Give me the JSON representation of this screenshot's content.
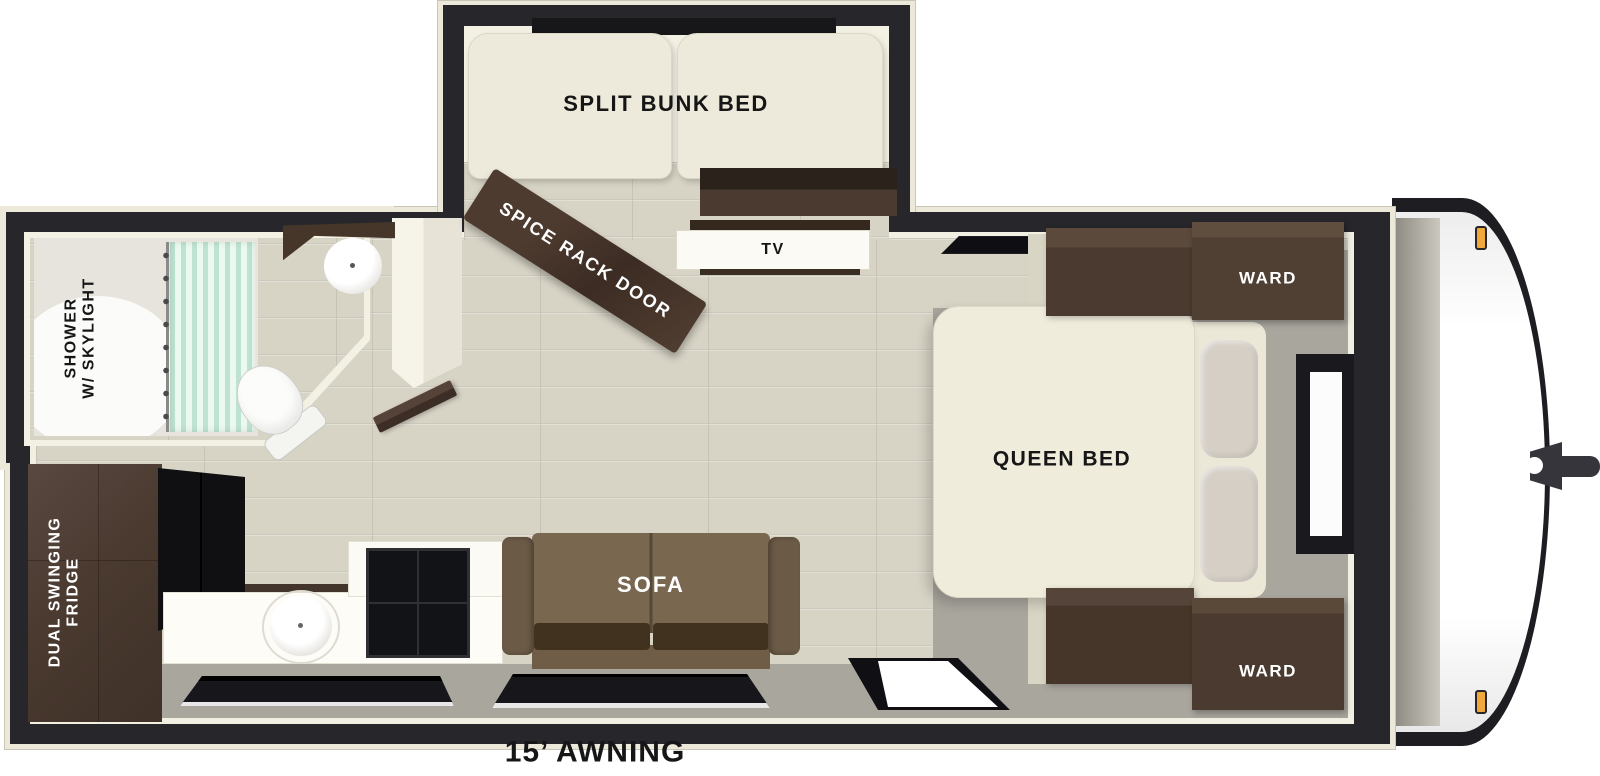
{
  "diagram": {
    "type": "rv-travel-trailer-floorplan",
    "labels": {
      "split_bunk_bed": "SPLIT BUNK BED",
      "spice_rack_door": "SPICE RACK DOOR",
      "tv": "TV",
      "shower": "SHOWER\nW/ SKYLIGHT",
      "fridge": "DUAL SWINGING\nFRIDGE",
      "sofa": "SOFA",
      "queen_bed": "QUEEN BED",
      "ward_top": "WARD",
      "ward_bottom": "WARD",
      "awning": "15’ AWNING"
    },
    "features": [
      "split bunk bed slide-out with window",
      "spice rack door",
      "TV cabinet",
      "roof vent",
      "bathroom slide-out with shower w/ skylight, toilet, corner sink",
      "dual swinging fridge",
      "kitchen sink and cooktop",
      "sofa",
      "queen bed with two wardrobes and window",
      "entry door",
      "15 ft awning",
      "front cap with hitch and marker lights"
    ],
    "colors": {
      "wall": "#26262b",
      "outline": "#ece9db",
      "wood_floor": "#d7d3c5",
      "bedroom_floor": "#a9a69e",
      "cabinet_wood": "#4a3a30",
      "mattress": "#efecda",
      "sofa_brown": "#79674f",
      "seat_cushion": "#41321f",
      "shower_curtain": "#bfe3d2",
      "marker_light": "#f0a73c",
      "appliance_black": "#121316",
      "pillow": "#d5cfc6"
    }
  }
}
